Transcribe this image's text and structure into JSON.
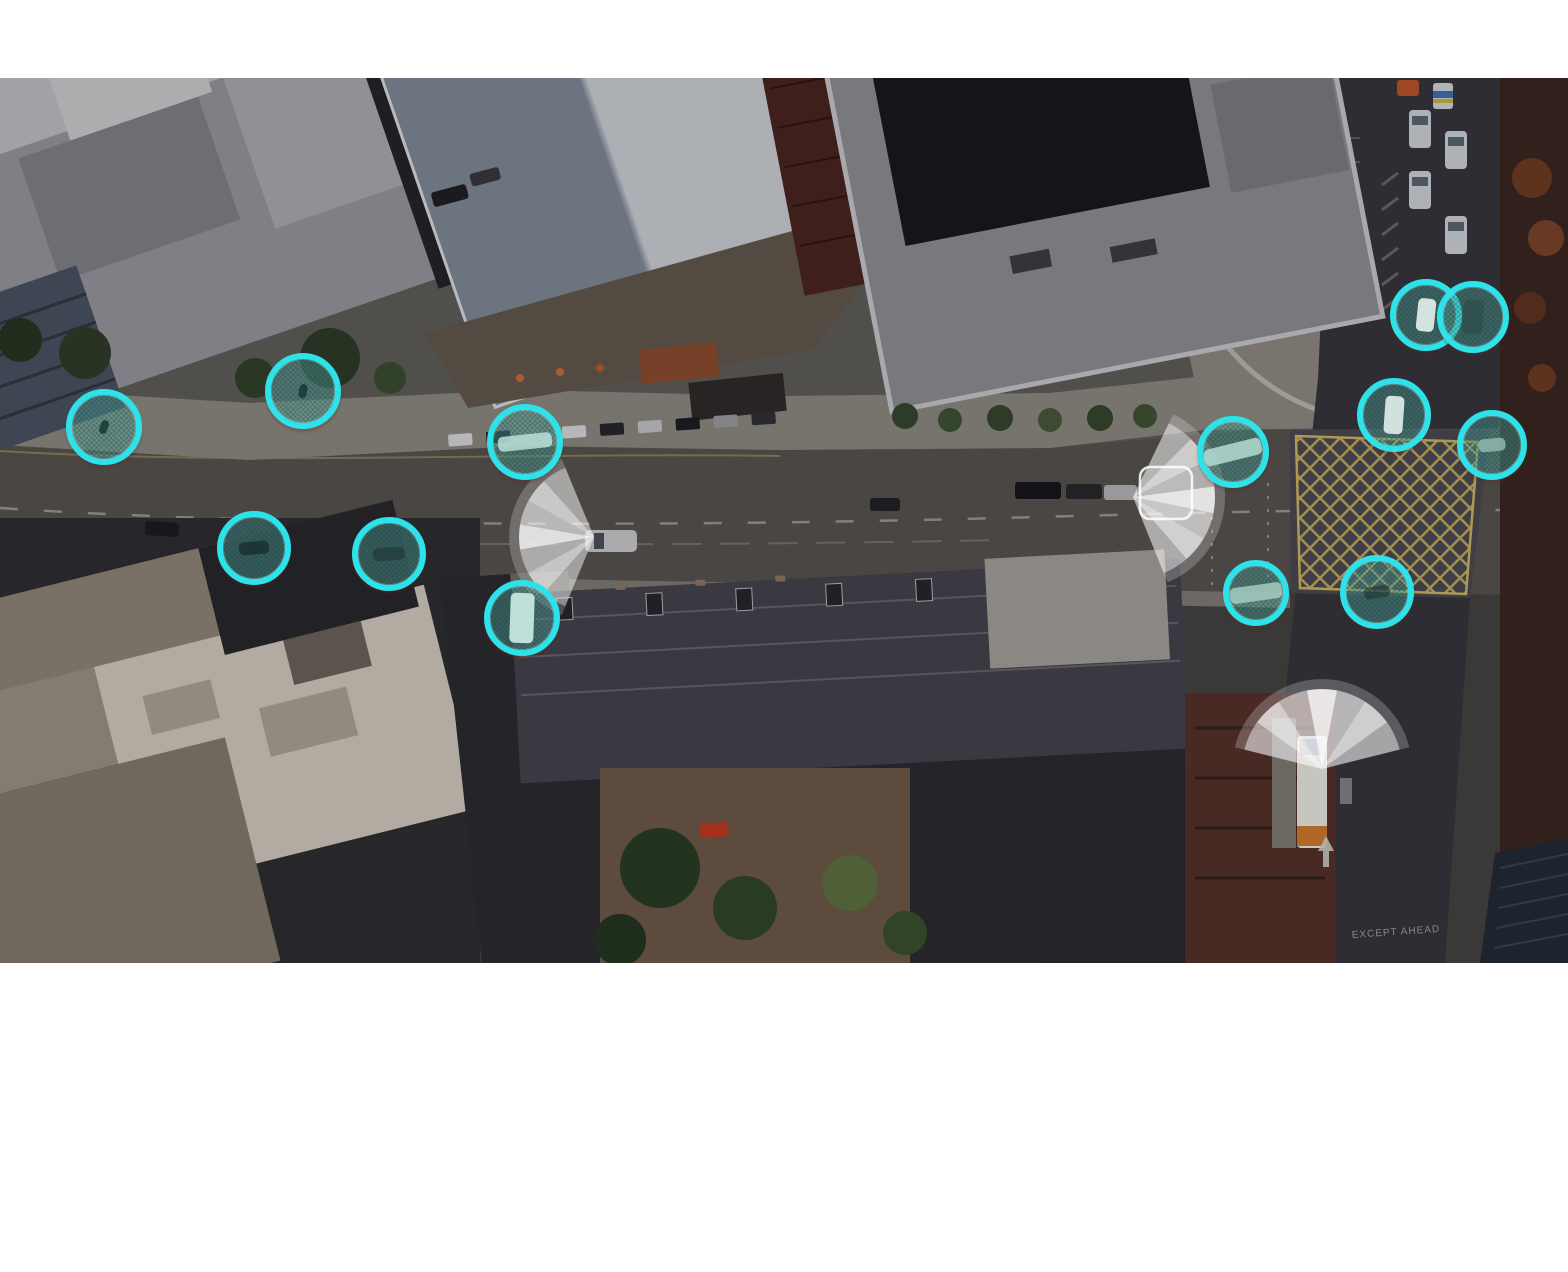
{
  "scene": {
    "description": "Dimmed aerial photo of an urban street corridor with AI traffic-detection overlays",
    "coordinate_space": "photo-local pixels, origin at top-left of photo area",
    "road_text": "EXCEPT AHEAD",
    "colors": {
      "detection_ring": "#2de2e9",
      "detection_fill": "rgba(95,185,175,0.38)",
      "sensor_cone": "#ffffff",
      "box_junction_yellow": "#c9b45f"
    }
  },
  "overlays": {
    "detections": [
      {
        "id": 1,
        "type": "pedestrian",
        "cx": 104,
        "cy": 349,
        "r": 38,
        "glyph": {
          "w": 8,
          "h": 14,
          "rot": 20,
          "fill": "rgba(25,55,50,0.85)"
        }
      },
      {
        "id": 2,
        "type": "pedestrian",
        "cx": 303,
        "cy": 313,
        "r": 38,
        "glyph": {
          "w": 8,
          "h": 14,
          "rot": 10,
          "fill": "rgba(25,55,50,0.85)"
        }
      },
      {
        "id": 3,
        "type": "vehicle",
        "cx": 525,
        "cy": 364,
        "r": 38,
        "glyph": {
          "w": 54,
          "h": 15,
          "rot": -6,
          "fill": "rgba(185,225,215,0.85)"
        }
      },
      {
        "id": 4,
        "type": "vehicle",
        "cx": 254,
        "cy": 470,
        "r": 37,
        "glyph": {
          "w": 30,
          "h": 13,
          "rot": -5,
          "fill": "rgba(25,45,42,0.8)"
        }
      },
      {
        "id": 5,
        "type": "vehicle",
        "cx": 389,
        "cy": 476,
        "r": 37,
        "glyph": {
          "w": 32,
          "h": 13,
          "rot": -4,
          "fill": "rgba(35,60,55,0.75)"
        }
      },
      {
        "id": 6,
        "type": "vehicle",
        "cx": 522,
        "cy": 540,
        "r": 38,
        "glyph": {
          "w": 24,
          "h": 50,
          "rot": 2,
          "fill": "rgba(205,238,230,0.9)"
        }
      },
      {
        "id": 7,
        "type": "vehicle",
        "cx": 1233,
        "cy": 374,
        "r": 36,
        "glyph": {
          "w": 58,
          "h": 17,
          "rot": -14,
          "fill": "rgba(180,220,210,0.85)"
        }
      },
      {
        "id": 8,
        "type": "vehicle",
        "cx": 1256,
        "cy": 515,
        "r": 33,
        "glyph": {
          "w": 52,
          "h": 16,
          "rot": -8,
          "fill": "rgba(170,210,200,0.8)"
        }
      },
      {
        "id": 9,
        "type": "vehicle",
        "cx": 1377,
        "cy": 514,
        "r": 37,
        "glyph": {
          "w": 26,
          "h": 12,
          "rot": -10,
          "fill": "rgba(30,50,46,0.6)"
        }
      },
      {
        "id": 10,
        "type": "vehicle",
        "cx": 1394,
        "cy": 337,
        "r": 37,
        "glyph": {
          "w": 19,
          "h": 38,
          "rot": 4,
          "fill": "rgba(225,240,236,0.9)"
        }
      },
      {
        "id": 11,
        "type": "vehicle",
        "cx": 1492,
        "cy": 367,
        "r": 35,
        "glyph": {
          "w": 27,
          "h": 13,
          "rot": -5,
          "fill": "rgba(150,190,182,0.8)"
        }
      },
      {
        "id": 12,
        "type": "vehicle",
        "cx": 1426,
        "cy": 237,
        "r": 36,
        "glyph": {
          "w": 18,
          "h": 33,
          "rot": 6,
          "fill": "rgba(228,242,238,0.9)"
        }
      },
      {
        "id": 13,
        "type": "vehicle",
        "cx": 1473,
        "cy": 239,
        "r": 36,
        "glyph": {
          "w": 20,
          "h": 34,
          "rot": 4,
          "fill": "rgba(40,70,66,0.5)"
        }
      }
    ],
    "sensor_cones": [
      {
        "id": "west-facing-car-sensor",
        "x": 594,
        "y": 459,
        "radius": 75,
        "heading": 180,
        "spread": 135,
        "facets": [
          0.35,
          0.6,
          0.42,
          0.78,
          0.5,
          0.62,
          0.38
        ]
      },
      {
        "id": "east-facing-car-sensor",
        "x": 1133,
        "y": 419,
        "radius": 82,
        "heading": 2,
        "spread": 132,
        "facets": [
          0.4,
          0.65,
          0.45,
          0.8,
          0.55,
          0.68,
          0.42
        ],
        "bike_box": {
          "x": 1140,
          "y": 389,
          "w": 52,
          "h": 52,
          "rx": 10
        }
      },
      {
        "id": "bus-stop-sensor",
        "x": 1322,
        "y": 691,
        "radius": 80,
        "heading": -90,
        "spread": 152,
        "facets": [
          0.45,
          0.7,
          0.5,
          0.85,
          0.55,
          0.7,
          0.45
        ]
      }
    ]
  }
}
